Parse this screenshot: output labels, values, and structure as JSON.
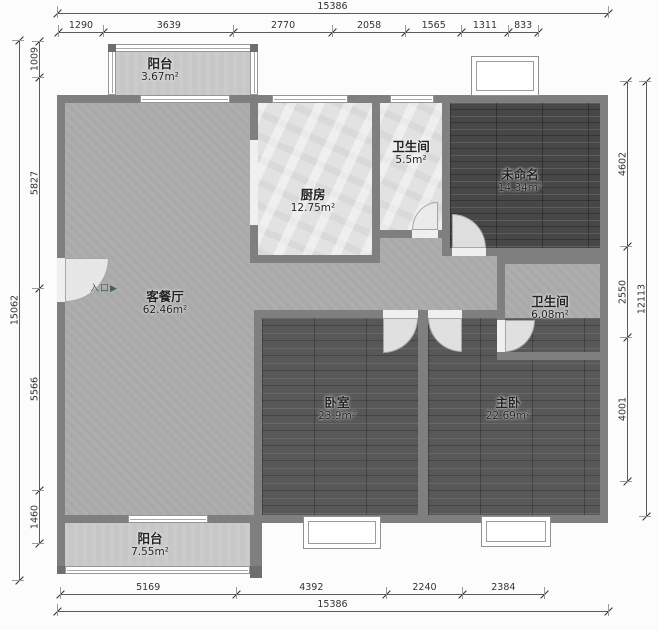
{
  "rooms": [
    {
      "id": "balcony-top",
      "name": "阳台",
      "area": "3.67m²"
    },
    {
      "id": "kitchen",
      "name": "厨房",
      "area": "12.75m²"
    },
    {
      "id": "bath-1",
      "name": "卫生间",
      "area": "5.5m²"
    },
    {
      "id": "unnamed",
      "name": "未命名",
      "area": "14.34m²"
    },
    {
      "id": "living-dining",
      "name": "客餐厅",
      "area": "62.46m²"
    },
    {
      "id": "bath-2",
      "name": "卫生间",
      "area": "6.08m²"
    },
    {
      "id": "bedroom",
      "name": "卧室",
      "area": "23.9m²"
    },
    {
      "id": "master-bedroom",
      "name": "主卧",
      "area": "22.69m²"
    },
    {
      "id": "balcony-bottom",
      "name": "阳台",
      "area": "7.55m²"
    }
  ],
  "entrance": {
    "label": "入口",
    "arrow": "▶"
  },
  "dimensions": {
    "top": {
      "total": "15386",
      "segments": [
        "1290",
        "3639",
        "2770",
        "2058",
        "1565",
        "1311",
        "833"
      ]
    },
    "bottom": {
      "total": "15386",
      "segments": [
        "5169",
        "4392",
        "2240",
        "2384"
      ]
    },
    "left": {
      "total": "15062",
      "segments": [
        "1009",
        "5827",
        "5566",
        "1460"
      ]
    },
    "right": {
      "total": "12113",
      "segments": [
        "4602",
        "2550",
        "4001"
      ]
    }
  },
  "colors": {
    "wall": "#7f7f7f",
    "living_floor": "#a9a9a9",
    "wood_floor_dark": "#474747",
    "wood_floor": "#585858",
    "tile_floor": "#e2e2e2",
    "balcony_floor": "#c7c7c7",
    "dimension_line": "#5a5a5a",
    "background": "#fcfcfc"
  }
}
